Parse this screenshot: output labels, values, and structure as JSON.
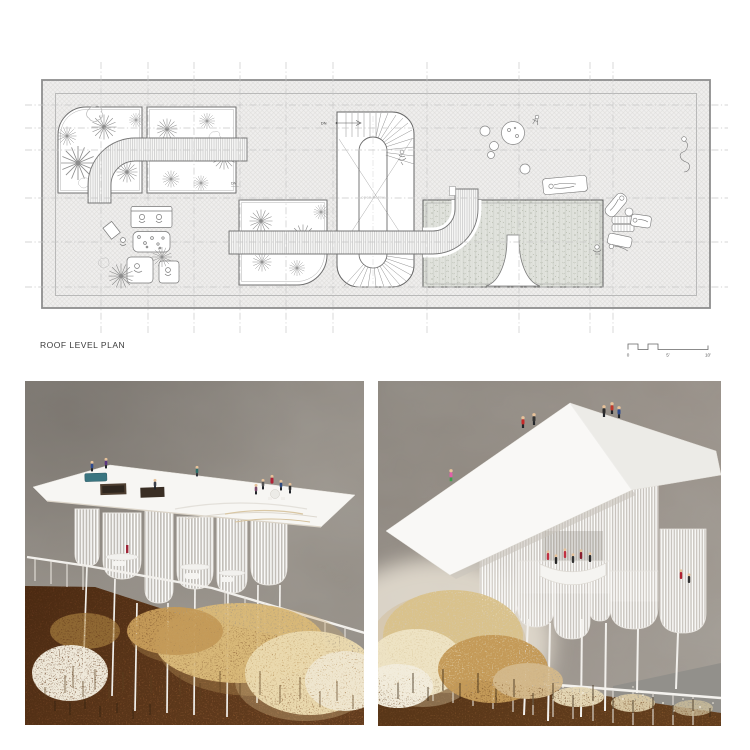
{
  "plan": {
    "title": "ROOF LEVEL PLAN",
    "annotations": {
      "stair_dn": "DN",
      "edge_dn": "DN",
      "open_below": "open below"
    },
    "scale_bar": {
      "zero": "0",
      "five": "5'",
      "ten": "10'"
    },
    "colors": {
      "linework": "#6e6e6e",
      "grid": "#c6c6c6",
      "hatch_line": "#dddcda",
      "roof_fill": "#efeeed",
      "pool_fill": "#e2e4de",
      "walkway_stripe": "#bfbfbf"
    }
  },
  "photos": {
    "left": {
      "colors": {
        "backdrop": "#948e86",
        "ground": "#7b4a26",
        "dried_plants": "#d8b878",
        "model_white": "#f6f5f2",
        "pool_teal": "#3a7580"
      },
      "figure_colors": [
        "#2e4a8f",
        "#5a3580",
        "#2f6f6a",
        "#b02236",
        "#2f4a7e",
        "#333333"
      ]
    },
    "right": {
      "colors": {
        "backdrop": "#978f87",
        "ground": "#714621",
        "dried_plants": "#d9c28c",
        "model_white": "#f9f8f6"
      },
      "figure_colors": [
        "#c52a2a",
        "#2e4b8f",
        "#e060a8",
        "#3da14b",
        "#c03040",
        "#222222"
      ]
    }
  }
}
